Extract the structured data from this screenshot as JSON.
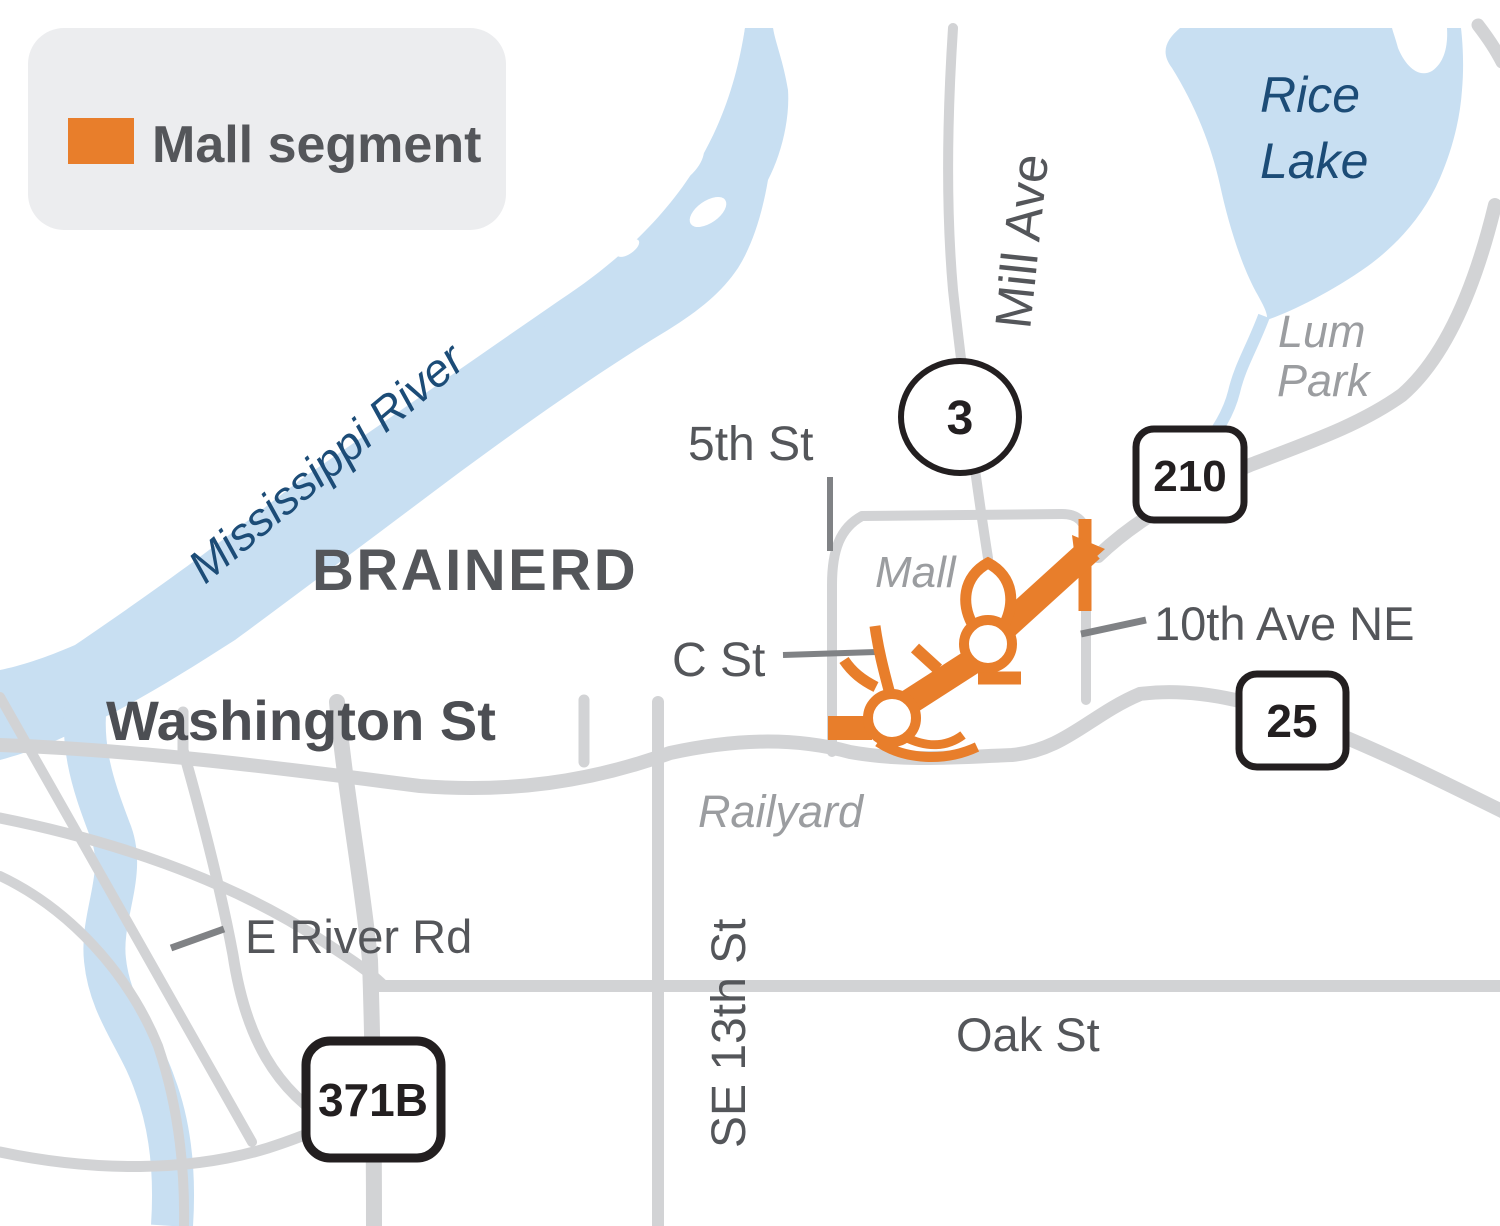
{
  "legend": {
    "title": "Mall segment"
  },
  "city_label": "BRAINERD",
  "water": {
    "river": "Mississippi River",
    "lake_line1": "Rice",
    "lake_line2": "Lake"
  },
  "areas": {
    "park_line1": "Lum",
    "park_line2": "Park",
    "mall": "Mall",
    "railyard": "Railyard"
  },
  "streets": {
    "mill_ave": "Mill Ave",
    "fifth_st": "5th St",
    "c_st": "C St",
    "washington": "Washington St",
    "tenth_ave_ne": "10th Ave NE",
    "e_river_rd": "E River Rd",
    "se_13th_st": "SE 13th St",
    "oak_st": "Oak St"
  },
  "route_shields": {
    "mn3": "3",
    "us210": "210",
    "mn25": "25",
    "biz371": "371B"
  },
  "colors": {
    "mall_segment_orange": "#E87E2B",
    "water_blue": "#C8DFF2",
    "road_gray": "#D2D3D5",
    "label_dark": "#54565A",
    "water_label_navy": "#1C4C77",
    "area_label_gray": "#9B9DA0"
  }
}
